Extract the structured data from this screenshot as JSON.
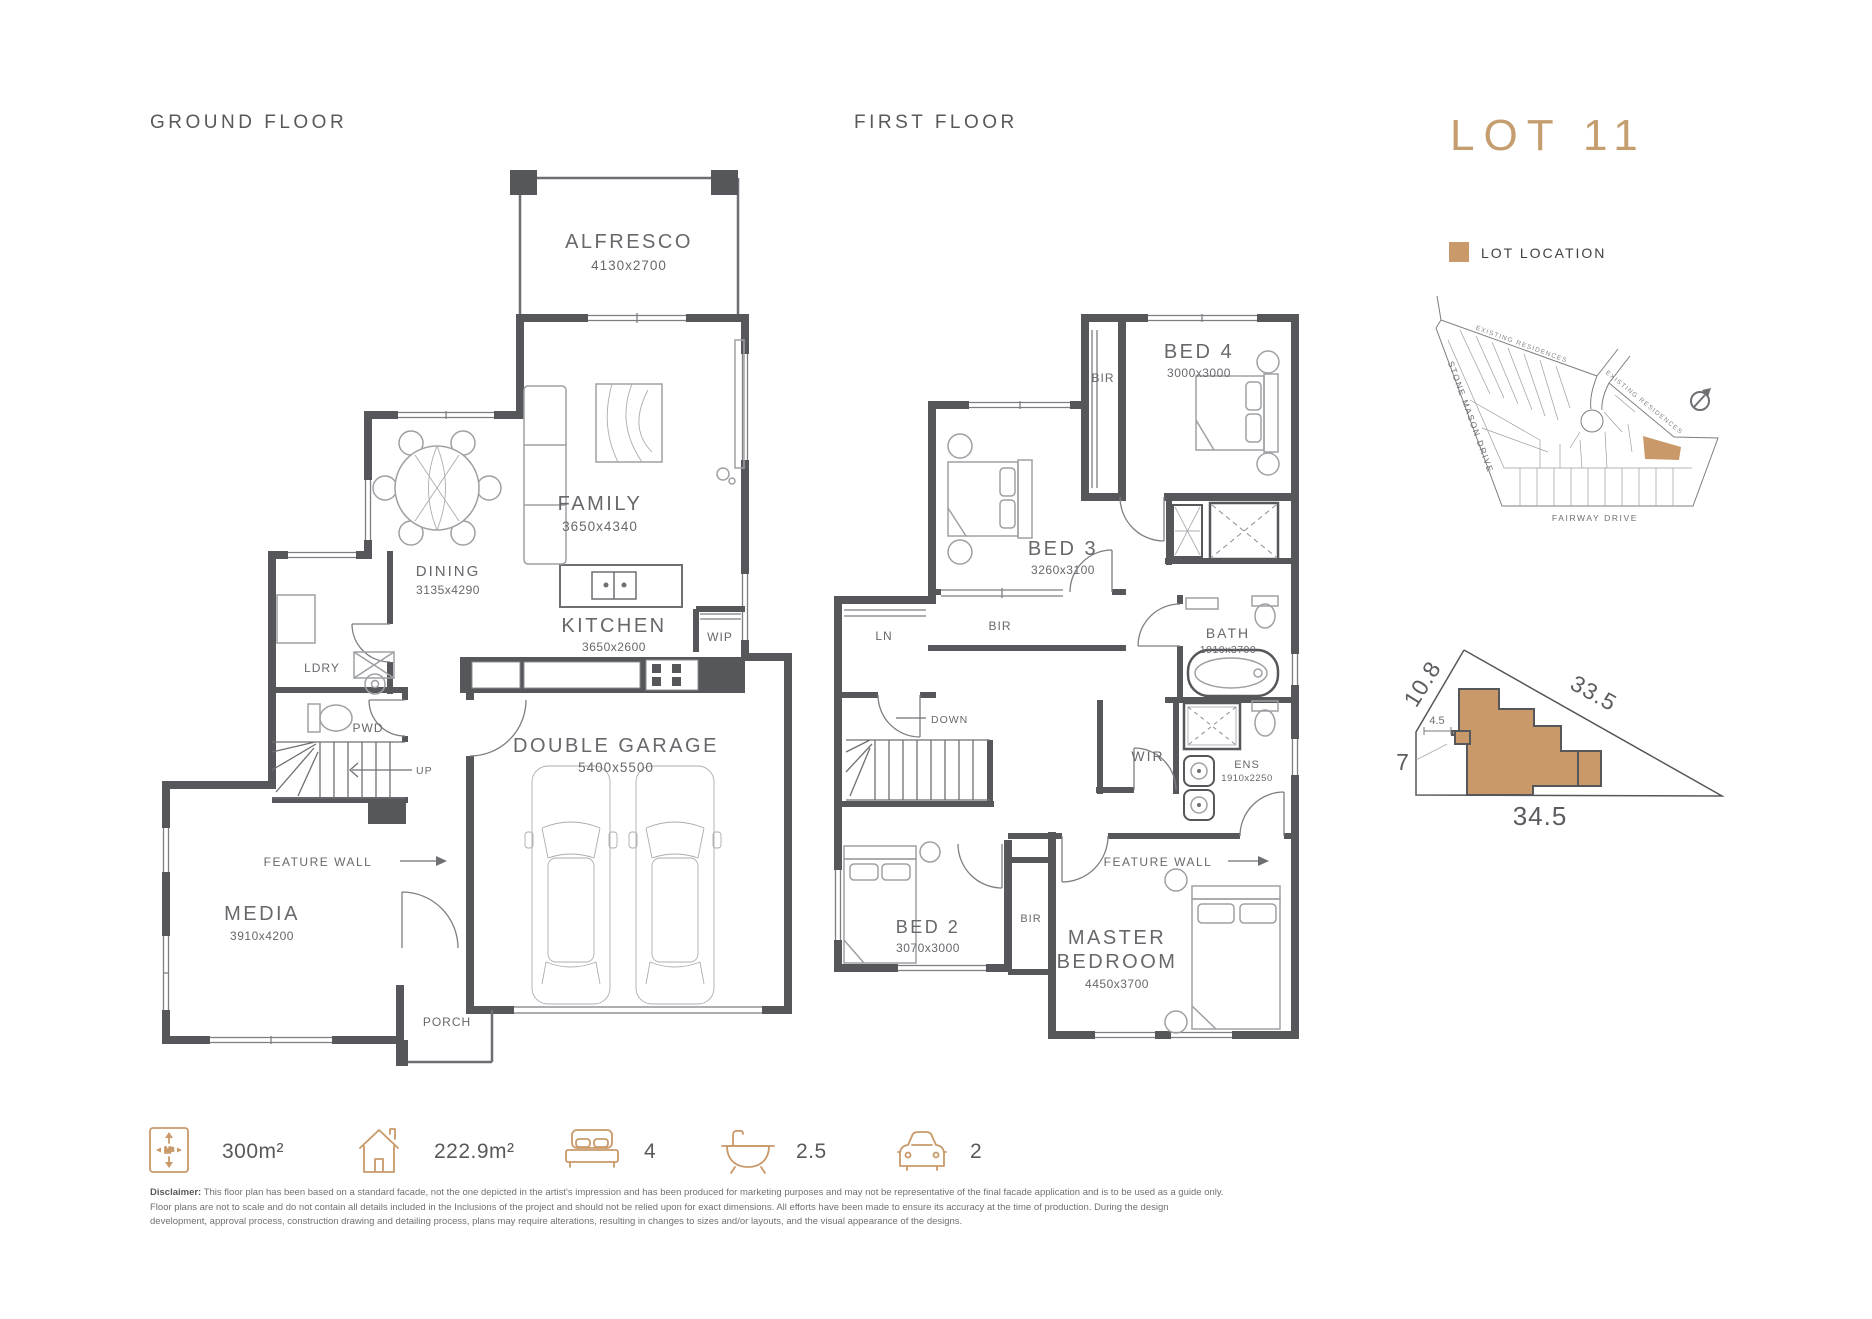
{
  "ground_floor": {
    "title": "GROUND FLOOR",
    "rooms": {
      "alfresco": {
        "name": "ALFRESCO",
        "dims": "4130x2700"
      },
      "family": {
        "name": "FAMILY",
        "dims": "3650x4340"
      },
      "dining": {
        "name": "DINING",
        "dims": "3135x4290"
      },
      "kitchen": {
        "name": "KITCHEN",
        "dims": "3650x2600"
      },
      "wip": {
        "name": "WIP"
      },
      "ldry": {
        "name": "LDRY"
      },
      "pwd": {
        "name": "PWD"
      },
      "media": {
        "name": "MEDIA",
        "dims": "3910x4200"
      },
      "garage": {
        "name": "DOUBLE GARAGE",
        "dims": "5400x5500"
      },
      "porch": {
        "name": "PORCH"
      }
    },
    "annotations": {
      "up": "UP",
      "feature_wall": "FEATURE WALL"
    }
  },
  "first_floor": {
    "title": "FIRST FLOOR",
    "rooms": {
      "bed4": {
        "name": "BED 4",
        "dims": "3000x3000"
      },
      "bir_bed4": {
        "name": "BIR"
      },
      "bed3": {
        "name": "BED 3",
        "dims": "3260x3100"
      },
      "bir_bed3": {
        "name": "BIR"
      },
      "ln": {
        "name": "LN"
      },
      "bath": {
        "name": "BATH",
        "dims": "1910x3700"
      },
      "wir": {
        "name": "WIR"
      },
      "ens": {
        "name": "ENS",
        "dims": "1910x2250"
      },
      "bed2": {
        "name": "BED 2",
        "dims": "3070x3000"
      },
      "bir_bed2": {
        "name": "BIR"
      },
      "master": {
        "name_line1": "MASTER",
        "name_line2": "BEDROOM",
        "dims": "4450x3700"
      }
    },
    "annotations": {
      "down": "DOWN",
      "feature_wall": "FEATURE WALL"
    }
  },
  "lot_panel": {
    "title": "LOT 11",
    "legend": "LOT LOCATION",
    "map": {
      "street_left": "STONE MASON DRIVE",
      "street_bottom": "FAIRWAY DRIVE",
      "existing_top": "EXISTING RESIDENCES",
      "existing_right": "EXISTING RESIDENCES"
    },
    "site": {
      "dim_top_left": "10.8",
      "dim_hypotenuse": "33.5",
      "dim_left": "7",
      "dim_bottom": "34.5",
      "dim_small": "4.5"
    }
  },
  "summary": {
    "land_area": "300m²",
    "house_area": "222.9m²",
    "beds": "4",
    "baths": "2.5",
    "cars": "2"
  },
  "colors": {
    "accent": "#c9996a",
    "wall": "#55575b",
    "lot_title": "#c59e70"
  },
  "disclaimer": {
    "label": "Disclaimer:",
    "body": " This floor plan has been based on a standard facade, not the one depicted in the artist's impression and has been produced for marketing purposes and may not be representative of the final facade application and is to be used as a guide only. Floor plans are not to scale and do not contain all details included in the Inclusions of the project and should not be relied upon for exact dimensions. All efforts have been made to ensure its accuracy at the time of production. During the design development, approval process, construction drawing and detailing process, plans may require alterations, resulting in changes to sizes and/or layouts, and the visual appearance of the designs."
  }
}
